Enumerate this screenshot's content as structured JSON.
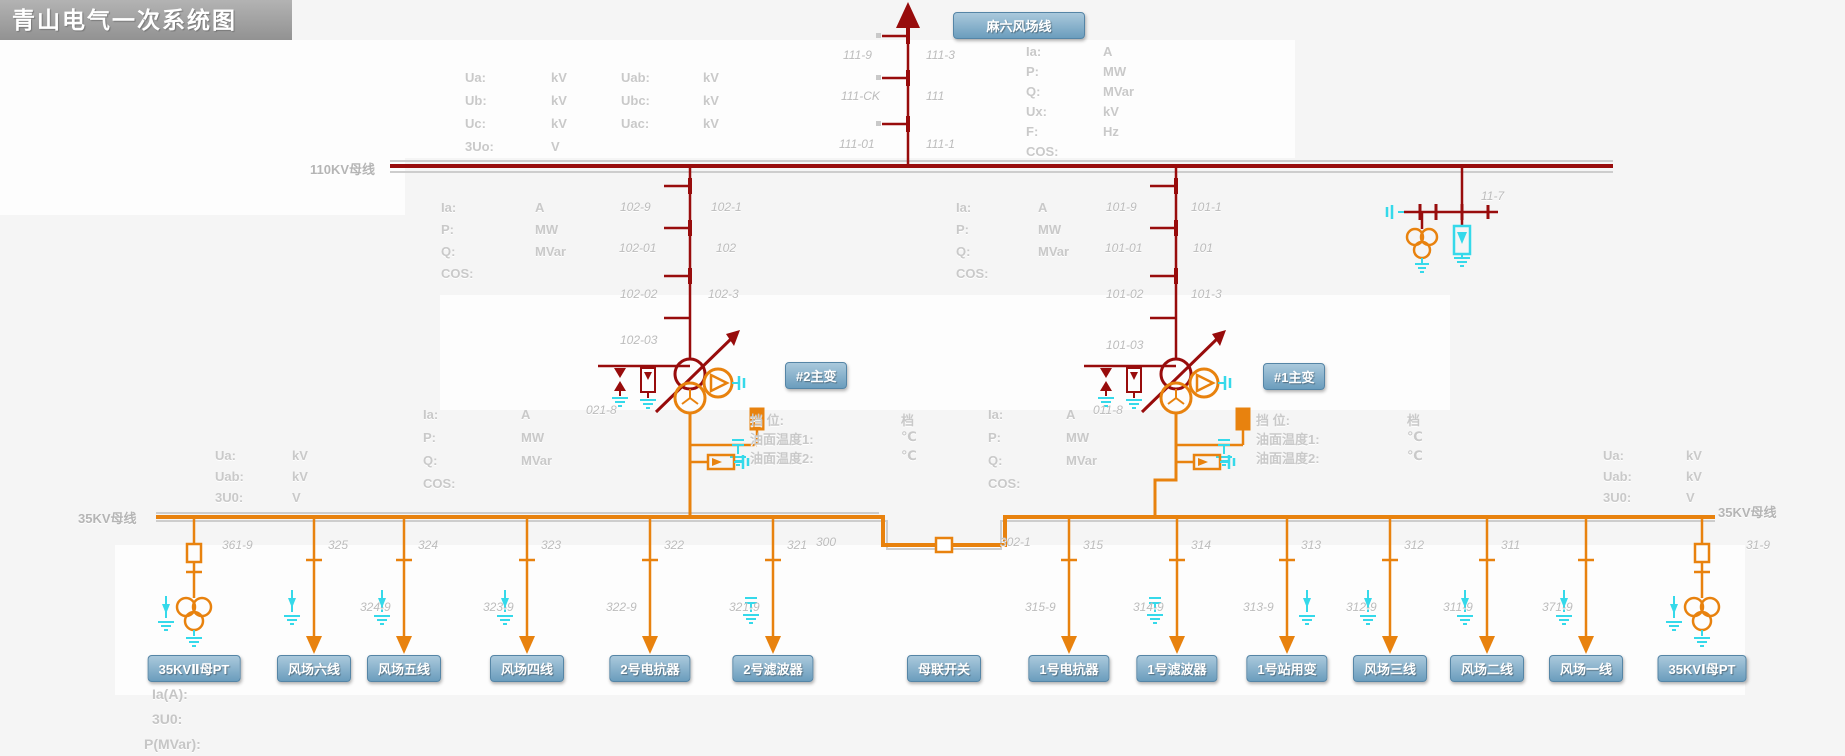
{
  "title": "青山电气一次系统图",
  "colors": {
    "hv": "#980c0c",
    "mv": "#e8820e",
    "cyan": "#35d9ea",
    "badge": "#6b9dbd",
    "gray_text": "#c9c9c9",
    "num_text": "#bcbcbc"
  },
  "top_line": {
    "badge": "麻六风场线"
  },
  "transformers": [
    {
      "badge": "#2主变",
      "neutral_label": "021-8"
    },
    {
      "badge": "#1主变",
      "neutral_label": "011-8"
    }
  ],
  "bus": {
    "hv_label": "110KV母线",
    "mv_label_left": "35KV母线",
    "mv_label_right": "35KV母线",
    "pt_bay_label": "11-7"
  },
  "corner_lines": [
    "Ia(A):",
    "3U0:",
    "P(MVar):"
  ],
  "switch_labels": [
    {
      "x": 843,
      "y": 48,
      "t": "111-9"
    },
    {
      "x": 926,
      "y": 48,
      "t": "111-3"
    },
    {
      "x": 841,
      "y": 89,
      "t": "111-CK"
    },
    {
      "x": 926,
      "y": 89,
      "t": "111"
    },
    {
      "x": 839,
      "y": 137,
      "t": "111-01"
    },
    {
      "x": 926,
      "y": 137,
      "t": "111-1"
    },
    {
      "x": 620,
      "y": 200,
      "t": "102-9"
    },
    {
      "x": 711,
      "y": 200,
      "t": "102-1"
    },
    {
      "x": 619,
      "y": 241,
      "t": "102-01"
    },
    {
      "x": 716,
      "y": 241,
      "t": "102"
    },
    {
      "x": 620,
      "y": 287,
      "t": "102-02"
    },
    {
      "x": 708,
      "y": 287,
      "t": "102-3"
    },
    {
      "x": 620,
      "y": 333,
      "t": "102-03"
    },
    {
      "x": 1106,
      "y": 200,
      "t": "101-9"
    },
    {
      "x": 1191,
      "y": 200,
      "t": "101-1"
    },
    {
      "x": 1105,
      "y": 241,
      "t": "101-01"
    },
    {
      "x": 1193,
      "y": 241,
      "t": "101"
    },
    {
      "x": 1106,
      "y": 287,
      "t": "101-02"
    },
    {
      "x": 1191,
      "y": 287,
      "t": "101-3"
    },
    {
      "x": 1106,
      "y": 338,
      "t": "101-03"
    },
    {
      "x": 1481,
      "y": 189,
      "t": "11-7"
    },
    {
      "x": 586,
      "y": 403,
      "t": "021-8"
    },
    {
      "x": 1093,
      "y": 403,
      "t": "011-8"
    },
    {
      "x": 816,
      "y": 535,
      "t": "300"
    },
    {
      "x": 1000,
      "y": 535,
      "t": "302-1"
    }
  ],
  "meas_blocks": [
    {
      "x": 465,
      "ux": 551,
      "y": 70,
      "dy": 23,
      "rows": [
        [
          "Ua:",
          "kV"
        ],
        [
          "Ub:",
          "kV"
        ],
        [
          "Uc:",
          "kV"
        ],
        [
          "3Uo:",
          "V"
        ]
      ]
    },
    {
      "x": 621,
      "ux": 703,
      "y": 70,
      "dy": 23,
      "rows": [
        [
          "Uab:",
          "kV"
        ],
        [
          "Ubc:",
          "kV"
        ],
        [
          "Uac:",
          "kV"
        ]
      ]
    },
    {
      "x": 1026,
      "ux": 1103,
      "y": 44,
      "dy": 20,
      "rows": [
        [
          "Ia:",
          "A"
        ],
        [
          "P:",
          "MW"
        ],
        [
          "Q:",
          "MVar"
        ],
        [
          "Ux:",
          "kV"
        ],
        [
          "F:",
          "Hz"
        ],
        [
          "COS:",
          ""
        ]
      ]
    },
    {
      "x": 441,
      "ux": 535,
      "y": 200,
      "dy": 22,
      "rows": [
        [
          "Ia:",
          "A"
        ],
        [
          "P:",
          "MW"
        ],
        [
          "Q:",
          "MVar"
        ],
        [
          "COS:",
          ""
        ]
      ]
    },
    {
      "x": 956,
      "ux": 1038,
      "y": 200,
      "dy": 22,
      "rows": [
        [
          "Ia:",
          "A"
        ],
        [
          "P:",
          "MW"
        ],
        [
          "Q:",
          "MVar"
        ],
        [
          "COS:",
          ""
        ]
      ]
    },
    {
      "x": 423,
      "ux": 521,
      "y": 407,
      "dy": 23,
      "rows": [
        [
          "Ia:",
          "A"
        ],
        [
          "P:",
          "MW"
        ],
        [
          "Q:",
          "MVar"
        ],
        [
          "COS:",
          ""
        ]
      ]
    },
    {
      "x": 988,
      "ux": 1066,
      "y": 407,
      "dy": 23,
      "rows": [
        [
          "Ia:",
          "A"
        ],
        [
          "P:",
          "MW"
        ],
        [
          "Q:",
          "MVar"
        ],
        [
          "COS:",
          ""
        ]
      ]
    },
    {
      "x": 215,
      "ux": 292,
      "y": 448,
      "dy": 21,
      "rows": [
        [
          "Ua:",
          "kV"
        ],
        [
          "Uab:",
          "kV"
        ],
        [
          "3U0:",
          "V"
        ]
      ]
    },
    {
      "x": 1603,
      "ux": 1686,
      "y": 448,
      "dy": 21,
      "rows": [
        [
          "Ua:",
          "kV"
        ],
        [
          "Uab:",
          "kV"
        ],
        [
          "3U0:",
          "V"
        ]
      ]
    },
    {
      "x": 750,
      "ux": 901,
      "y": 410,
      "dy": 19,
      "rows": [
        [
          "挡  位:",
          "档"
        ],
        [
          "油面温度1:",
          "℃"
        ],
        [
          "油面温度2:",
          "℃"
        ]
      ]
    },
    {
      "x": 1256,
      "ux": 1407,
      "y": 410,
      "dy": 19,
      "rows": [
        [
          "挡  位:",
          "档"
        ],
        [
          "油面温度1:",
          "℃"
        ],
        [
          "油面温度2:",
          "℃"
        ]
      ]
    }
  ],
  "feeders": [
    {
      "x": 194,
      "badge": "35KVⅡ母PT",
      "num": "361-9",
      "num_dx": 28,
      "sub": "",
      "type": "pt"
    },
    {
      "x": 314,
      "badge": "风场六线",
      "num": "325",
      "sub": "",
      "type": "wind"
    },
    {
      "x": 404,
      "badge": "风场五线",
      "num": "324",
      "sub": "324-9",
      "type": "wind"
    },
    {
      "x": 527,
      "badge": "风场四线",
      "num": "323",
      "sub": "323-9",
      "type": "wind"
    },
    {
      "x": 650,
      "badge": "2号电抗器",
      "num": "322",
      "sub": "322-9",
      "type": "reactor"
    },
    {
      "x": 773,
      "badge": "2号滤波器",
      "num": "321",
      "sub": "321-9",
      "type": "filter"
    },
    {
      "x": 944,
      "badge": "母联开关",
      "num": "",
      "sub": "",
      "type": "tie"
    },
    {
      "x": 1069,
      "badge": "1号电抗器",
      "num": "315",
      "sub": "315-9",
      "type": "reactor"
    },
    {
      "x": 1177,
      "badge": "1号滤波器",
      "num": "314",
      "sub": "314-9",
      "type": "filter"
    },
    {
      "x": 1287,
      "badge": "1号站用变",
      "num": "313",
      "sub": "313-9",
      "type": "station"
    },
    {
      "x": 1390,
      "badge": "风场三线",
      "num": "312",
      "sub": "312-9",
      "type": "wind"
    },
    {
      "x": 1487,
      "badge": "风场二线",
      "num": "311",
      "sub": "311-9",
      "type": "wind"
    },
    {
      "x": 1586,
      "badge": "风场一线",
      "num": "",
      "sub": "371-9",
      "type": "wind"
    },
    {
      "x": 1702,
      "badge": "35KVⅠ母PT",
      "num": "31-9",
      "num_dx": 44,
      "sub": "",
      "type": "pt"
    }
  ]
}
